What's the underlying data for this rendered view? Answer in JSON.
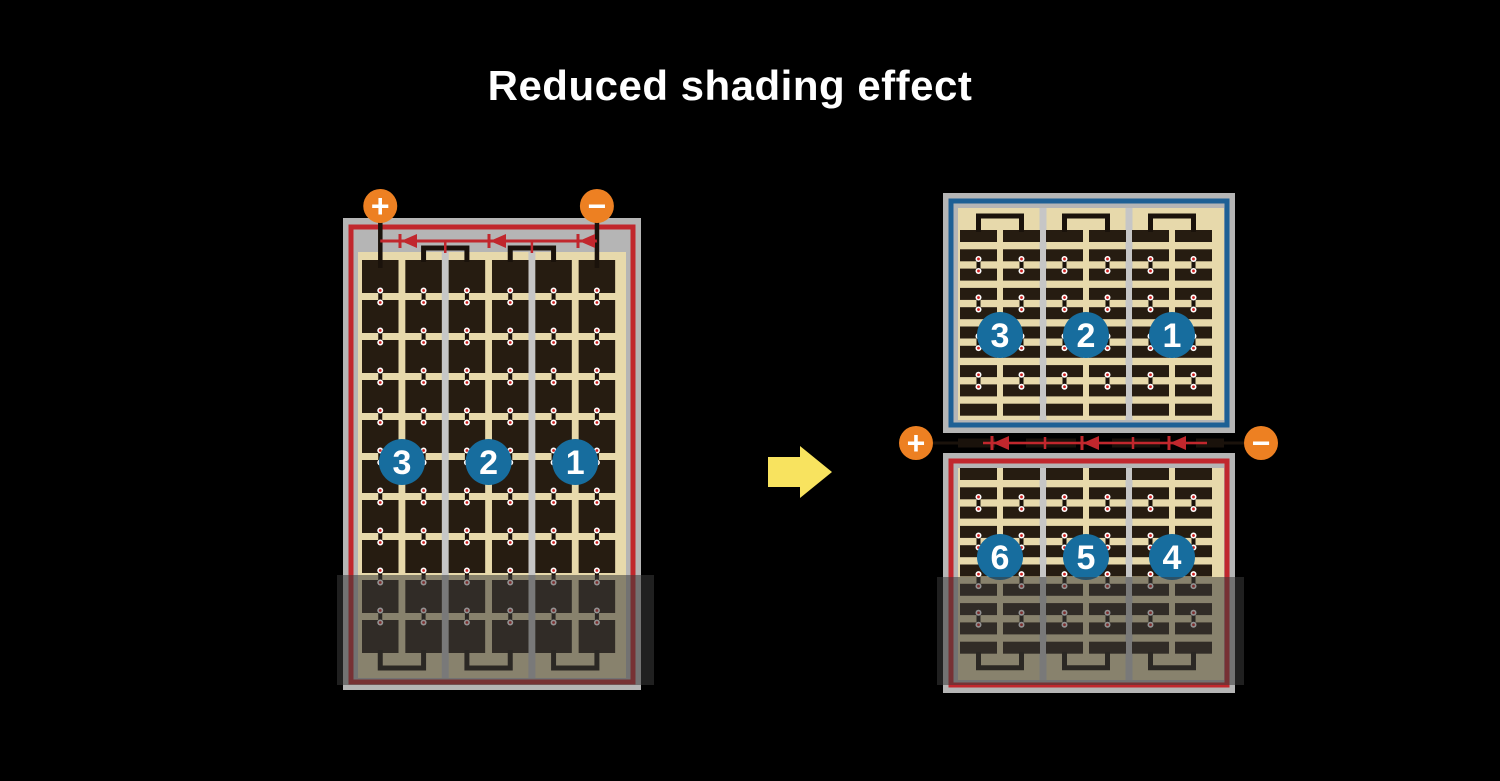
{
  "title": "Reduced shading effect",
  "colors": {
    "background": "#000000",
    "title_text": "#ffffff",
    "panel_frame": "#b5b5b5",
    "panel_divider": "#c6c6c6",
    "cell_area_tan": "#e7d9ab",
    "cell_dark": "#261c11",
    "circuit_red": "#c1272d",
    "circuit_blue": "#1e6095",
    "terminal_orange": "#ed8022",
    "badge_blue": "#176d9e",
    "badge_text": "#ffffff",
    "arrow_yellow": "#f8e35f",
    "shade_overlay": "#3b3b3b",
    "wire_black": "#1a120b",
    "connector_red": "#cc2020",
    "connector_white": "#ffffff"
  },
  "left_panel": {
    "description": "full-cell module, single series circuit with bypass diodes",
    "terminals": {
      "positive": "+",
      "negative": "−"
    },
    "string_labels": [
      "3",
      "2",
      "1"
    ],
    "diode_count": 3,
    "shading": "bottom band"
  },
  "right_panel": {
    "description": "half-cut cell module, split into two series circuits",
    "terminals": {
      "positive": "+",
      "negative": "−"
    },
    "top_half": {
      "string_labels": [
        "3",
        "2",
        "1"
      ]
    },
    "bottom_half": {
      "string_labels": [
        "6",
        "5",
        "4"
      ]
    },
    "diode_count": 3,
    "shading": "bottom band"
  },
  "arrow": {
    "meaning": "transforms to",
    "direction": "right"
  }
}
